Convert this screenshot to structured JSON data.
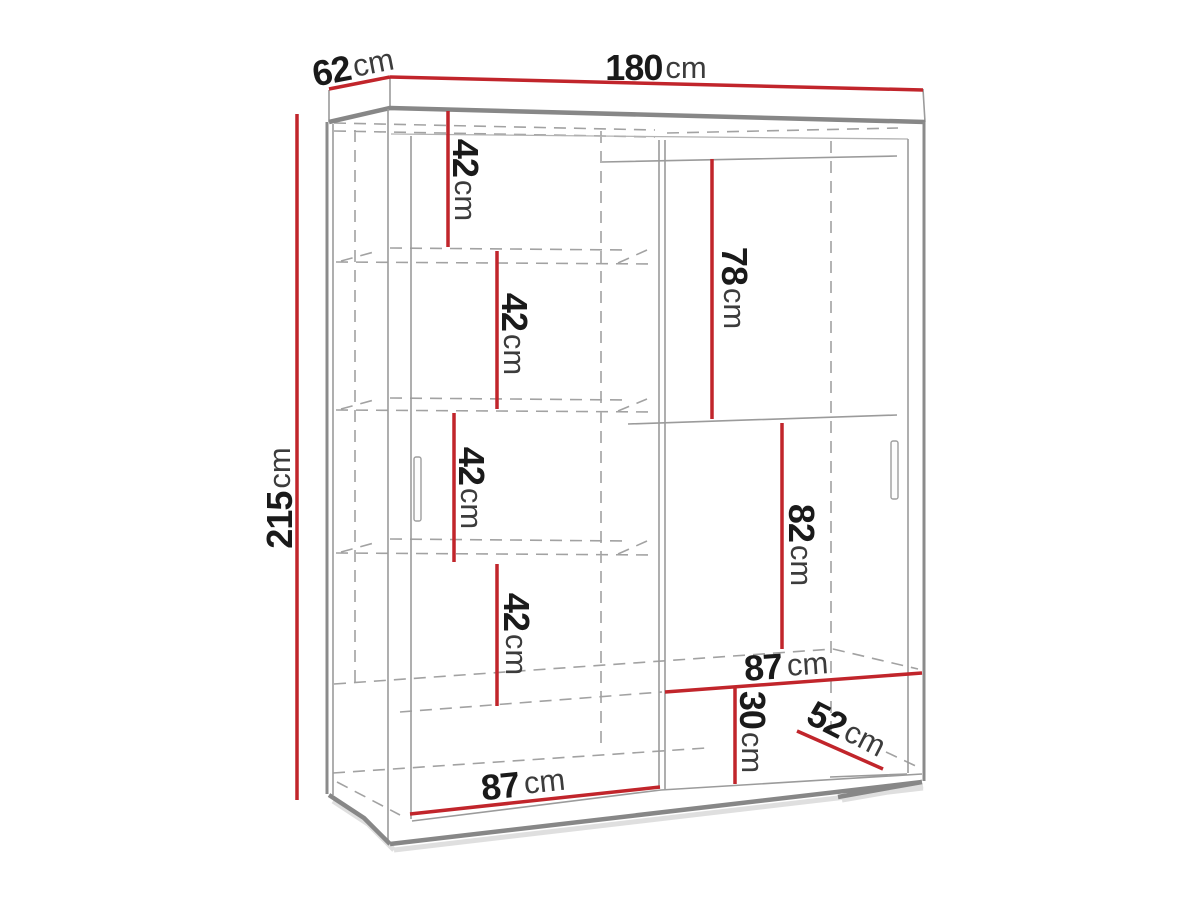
{
  "diagram": {
    "subject": "sliding-door wardrobe dimension drawing",
    "unit_default": "cm",
    "colors": {
      "dimension_red": "#c1252b",
      "structure_gray": "#878787",
      "dashed_gray": "#a2a2a2",
      "digit_black": "#1a1a1a",
      "unit_gray": "#3c3c3c",
      "background": "#ffffff"
    },
    "dims": {
      "total_width": {
        "value": "180",
        "unit": "cm"
      },
      "total_depth_top": {
        "value": "62",
        "unit": "cm"
      },
      "total_height": {
        "value": "215",
        "unit": "cm"
      },
      "left_gap_1": {
        "value": "42",
        "unit": "cm"
      },
      "left_gap_2": {
        "value": "42",
        "unit": "cm"
      },
      "left_gap_3": {
        "value": "42",
        "unit": "cm"
      },
      "left_gap_4": {
        "value": "42",
        "unit": "cm"
      },
      "right_upper_height": {
        "value": "78",
        "unit": "cm"
      },
      "right_lower_height": {
        "value": "82",
        "unit": "cm"
      },
      "bottom_right_width": {
        "value": "87",
        "unit": "cm"
      },
      "bottom_niche_height": {
        "value": "30",
        "unit": "cm"
      },
      "bottom_depth": {
        "value": "52",
        "unit": "cm"
      },
      "bottom_left_width": {
        "value": "87",
        "unit": "cm"
      }
    }
  }
}
